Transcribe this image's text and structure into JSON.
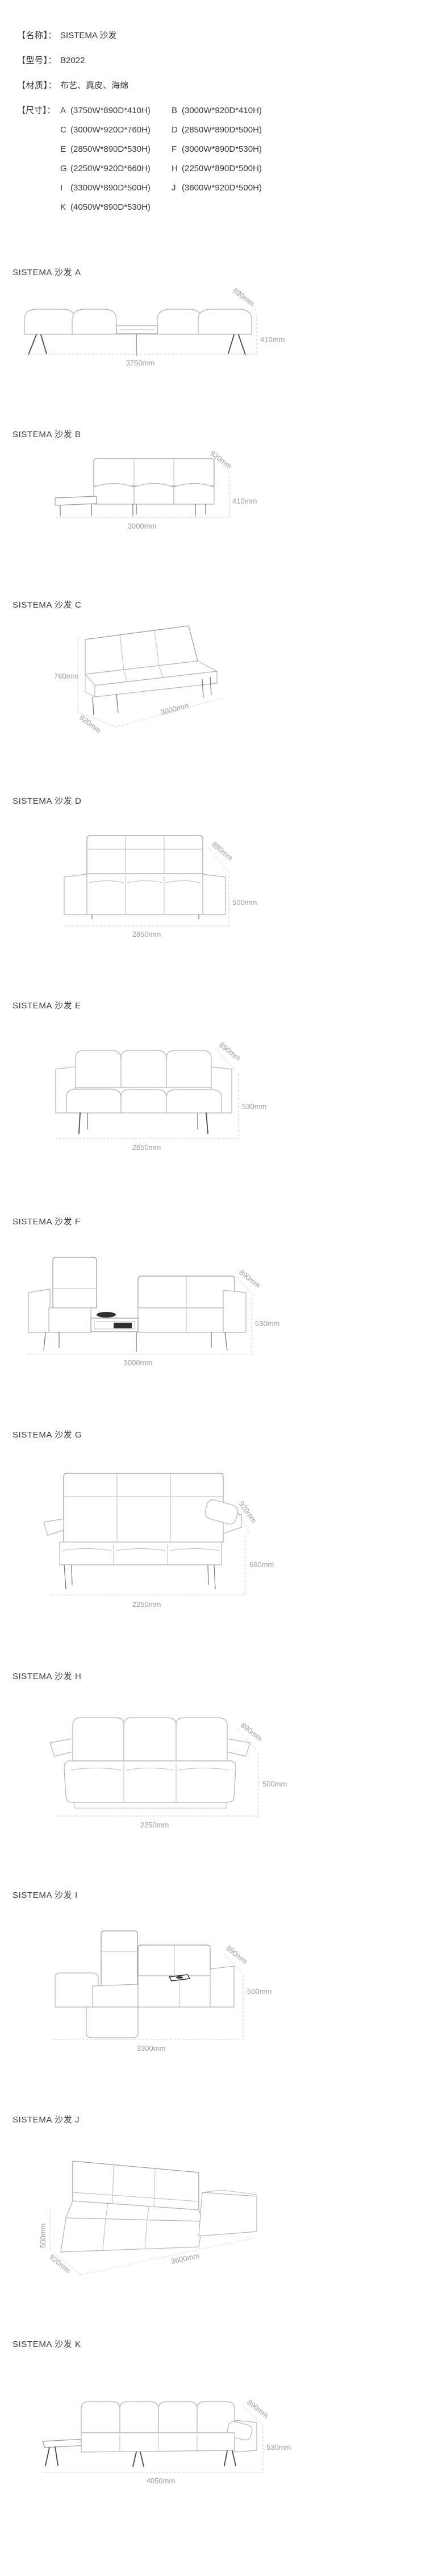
{
  "header": {
    "fields": [
      {
        "label": "【名称】",
        "colon": "：",
        "value": "SISTEMA 沙发"
      },
      {
        "label": "【型号】",
        "colon": "：",
        "value": "B2022"
      },
      {
        "label": "【材质】",
        "colon": "：",
        "value": "布艺、真皮、海绵"
      }
    ],
    "size_label": "【尺寸】",
    "size_colon": "：",
    "sizes": [
      {
        "code": "A",
        "dims": "(3750W*890D*410H)"
      },
      {
        "code": "B",
        "dims": "(3000W*920D*410H)"
      },
      {
        "code": "C",
        "dims": "(3000W*920D*760H)"
      },
      {
        "code": "D",
        "dims": "(2850W*890D*500H)"
      },
      {
        "code": "E",
        "dims": "(2850W*890D*530H)"
      },
      {
        "code": "F",
        "dims": "(3000W*890D*530H)"
      },
      {
        "code": "G",
        "dims": "(2250W*920D*660H)"
      },
      {
        "code": "H",
        "dims": "(2250W*890D*500H)"
      },
      {
        "code": "I",
        "dims": "(3300W*890D*500H)"
      },
      {
        "code": "J",
        "dims": "(3600W*920D*500H)"
      },
      {
        "code": "K",
        "dims": "(4050W*890D*530H)"
      }
    ]
  },
  "sections": [
    {
      "id": "A",
      "title": "SISTEMA 沙发 A",
      "width": "3750mm",
      "depth": "890mm",
      "height": "410mm"
    },
    {
      "id": "B",
      "title": "SISTEMA 沙发 B",
      "width": "3000mm",
      "depth": "920mm",
      "height": "410mm"
    },
    {
      "id": "C",
      "title": "SISTEMA 沙发 C",
      "width": "3000mm",
      "depth": "920mm",
      "height": "760mm"
    },
    {
      "id": "D",
      "title": "SISTEMA 沙发 D",
      "width": "2850mm",
      "depth": "890mm",
      "height": "500mm"
    },
    {
      "id": "E",
      "title": "SISTEMA 沙发 E",
      "width": "2850mm",
      "depth": "890mm",
      "height": "530mm"
    },
    {
      "id": "F",
      "title": "SISTEMA 沙发 F",
      "width": "3000mm",
      "depth": "890mm",
      "height": "530mm"
    },
    {
      "id": "G",
      "title": "SISTEMA 沙发 G",
      "width": "2250mm",
      "depth": "920mm",
      "height": "660mm"
    },
    {
      "id": "H",
      "title": "SISTEMA 沙发 H",
      "width": "2250mm",
      "depth": "890mm",
      "height": "500mm"
    },
    {
      "id": "I",
      "title": "SISTEMA 沙发 I",
      "width": "3300mm",
      "depth": "890mm",
      "height": "500mm"
    },
    {
      "id": "J",
      "title": "SISTEMA 沙发 J",
      "width": "3600mm",
      "depth": "920mm",
      "height": "500mm"
    },
    {
      "id": "K",
      "title": "SISTEMA 沙发 K",
      "width": "4050mm",
      "depth": "890mm",
      "height": "530mm"
    }
  ]
}
